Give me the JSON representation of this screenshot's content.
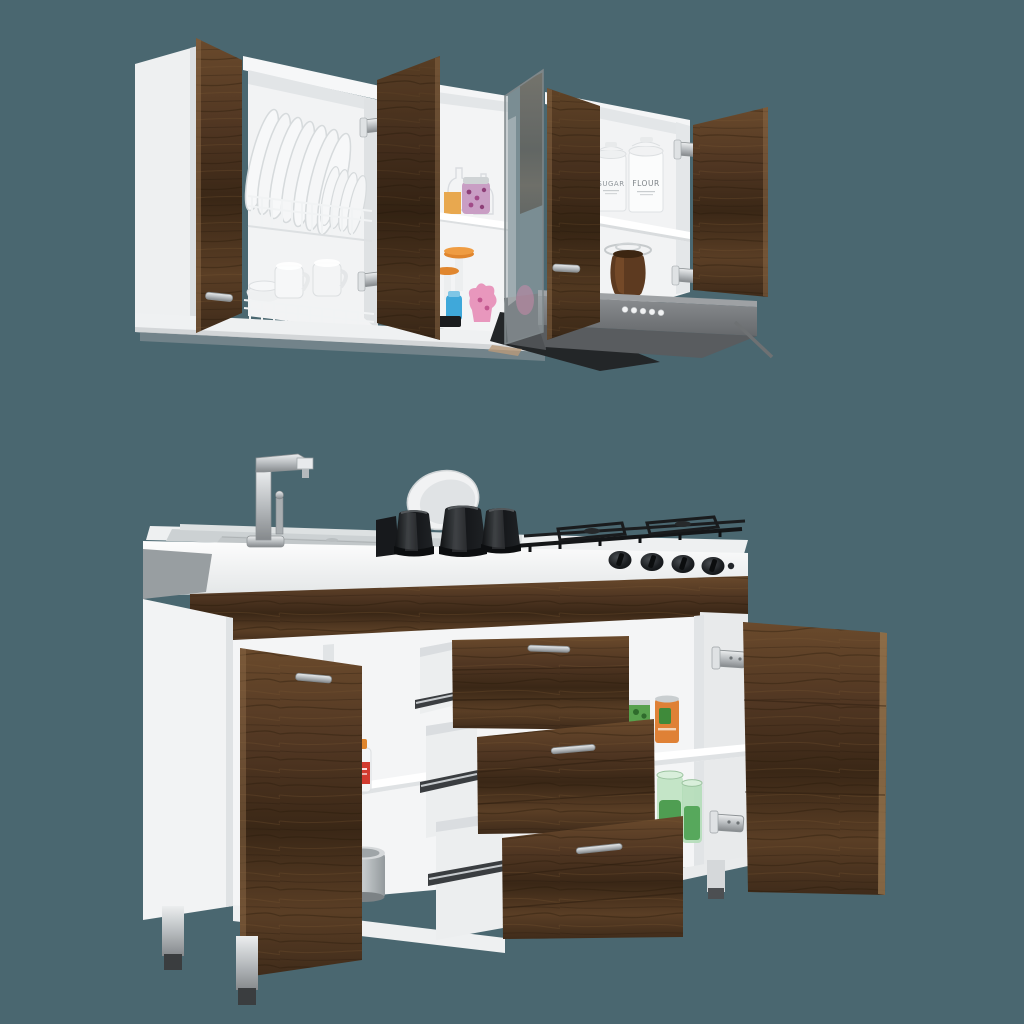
{
  "scene": {
    "type": "product-photo",
    "subject": "Two-piece kitchen cabinet set: wall cabinet with open doors and dish racks, and base sink/stove cabinet with open doors and three pulled-out drawers",
    "style": "white carcass with dark walnut doors and drawer fronts",
    "background_color": "#4a6770"
  },
  "wall_unit": {
    "sections": [
      "dish-rack cabinet",
      "narrow pantry shelves",
      "glass-door section",
      "canister cabinet over range hood"
    ],
    "dish_rack": {
      "large_plates": 7,
      "small_plates": 5,
      "mugs": 3,
      "tiers": 2
    },
    "canisters": {
      "sugar_label": "SUGAR",
      "flour_label": "FLOUR"
    },
    "pantry_items": [
      "candy jar",
      "orange box",
      "orange-lid pedestal jars",
      "pink gummy jar",
      "blue jar",
      "brown jar with glass lid"
    ],
    "range_hood": {
      "color": "#77797c",
      "buttons": 5,
      "button_color": "#f2f3f4"
    },
    "open_doors": 4,
    "hinge_color": "#c2c6c9"
  },
  "base_unit": {
    "countertop": [
      "stainless sink deck",
      "chrome faucet",
      "white bowl",
      "black pots upside down: 3",
      "gas grates",
      "control knobs: 4",
      "igniter button: 1"
    ],
    "drawers": {
      "count": 3,
      "front": "walnut",
      "handles": "chrome bar",
      "state": "pulled out in steps"
    },
    "left_cabinet_items": [
      "spray cleaner bottle",
      "aluminum pot"
    ],
    "right_cabinet_items": [
      "green can",
      "orange can",
      "green glass jars: 2"
    ],
    "open_doors": 2,
    "legs": {
      "count": 3,
      "finish": "chrome with dark feet"
    }
  },
  "colors": {
    "background": "#4a6770",
    "walnut_light": "#6e4e30",
    "walnut_dark": "#35241a",
    "carcass_white": "#f2f3f4",
    "hood_gray": "#77797c",
    "chrome": "#c2c6c9",
    "pot_black": "#1b1d20",
    "accent_orange": "#e0862e",
    "accent_pink": "#d478ab",
    "accent_blue": "#3fa8da",
    "accent_green": "#57a14e",
    "accent_red": "#d23b2f"
  }
}
